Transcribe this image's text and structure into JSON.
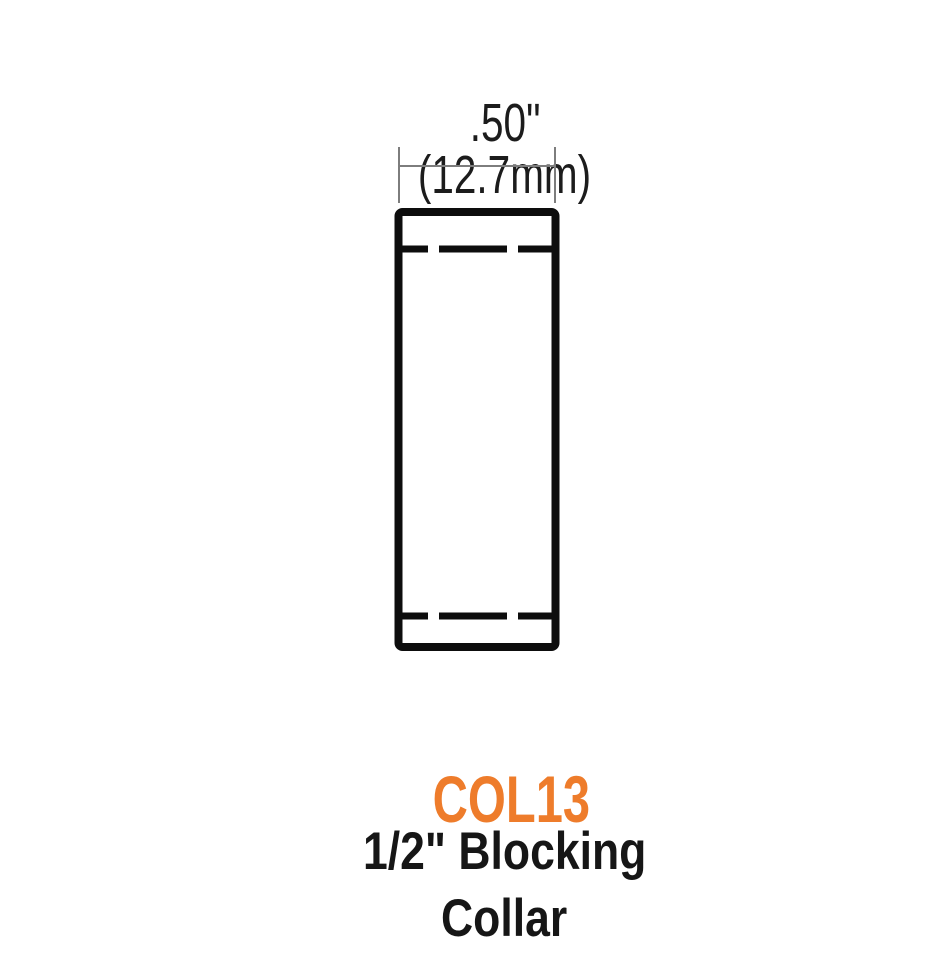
{
  "diagram": {
    "dimension_label": {
      "inches": ".50\"",
      "metric": "(12.7mm)"
    },
    "part_label": {
      "number": "COL13",
      "name_line1": "1/2\" Blocking",
      "name_line2": "Collar"
    },
    "colors": {
      "part_number_orange": "#ee7c2b",
      "drawing_black": "#0d0d0d",
      "text_black": "#161616",
      "dimension_line_gray": "#7d7d7d"
    }
  }
}
